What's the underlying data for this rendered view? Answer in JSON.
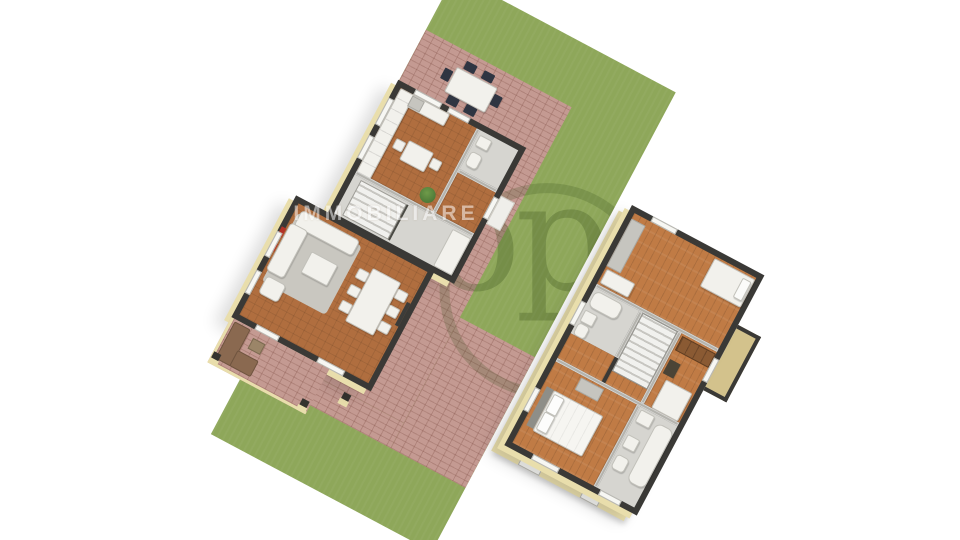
{
  "image_type": "3d-isometric-floor-plan-render",
  "watermark": {
    "small_text": "IMMOBILIARE",
    "large_text": "op"
  },
  "palette": {
    "bg": "#ffffff",
    "grass": "#8ea75a",
    "brick": "#c49a92",
    "terracotta": "#b06e3f",
    "wood": "#c07b45",
    "wall_dark": "#3a3936",
    "wall_mid": "#b4b3ad",
    "floor_gray": "#d6d5d0",
    "slab": "#e9deac",
    "furn_white": "#f2f1ec",
    "furn_gray": "#c6c5bf",
    "rug": "#c9c7c0",
    "sofa_brown": "#8a6950",
    "chair_dark": "#2f3542",
    "plant": "#4e7a38",
    "red_accent": "#b23327",
    "balcony_tan": "#d3c28c",
    "wm_green": "#2f4816",
    "wm_white": "#ffffff"
  },
  "scene": {
    "ground_floor": {
      "rooms": [
        "kitchen",
        "wc",
        "entry-hall",
        "staircase-hall",
        "living-room",
        "dining-area",
        "covered-porch"
      ],
      "outdoor": [
        "lawn",
        "brick-patio",
        "patio-dining-set"
      ]
    },
    "upper_floor": {
      "rooms": [
        "bedroom-1",
        "bathroom-1",
        "staircase",
        "bedroom-2",
        "balcony",
        "master-bedroom",
        "bathroom-2"
      ]
    }
  }
}
